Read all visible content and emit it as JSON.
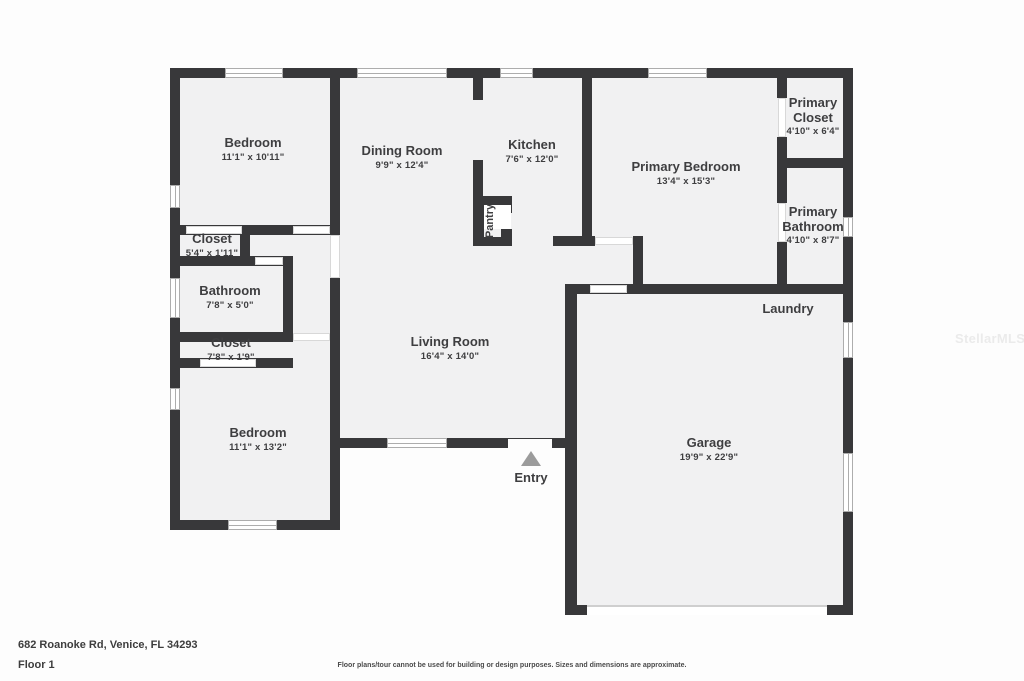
{
  "floorplan": {
    "rooms": [
      {
        "name": "Bedroom",
        "dims": "11'1\" x 10'11\""
      },
      {
        "name": "Dining Room",
        "dims": "9'9\" x 12'4\""
      },
      {
        "name": "Kitchen",
        "dims": "7'6\" x 12'0\""
      },
      {
        "name": "Primary Bedroom",
        "dims": "13'4\" x 15'3\""
      },
      {
        "name": "Primary Closet",
        "dims": "4'10\" x 6'4\""
      },
      {
        "name": "Primary Bathroom",
        "dims": "4'10\" x 8'7\""
      },
      {
        "name": "Closet",
        "dims": "5'4\" x 1'11\""
      },
      {
        "name": "Bathroom",
        "dims": "7'8\" x 5'0\""
      },
      {
        "name": "Closet",
        "dims": "7'8\" x 1'9\""
      },
      {
        "name": "Bedroom",
        "dims": "11'1\" x 13'2\""
      },
      {
        "name": "Living Room",
        "dims": "16'4\" x 14'0\""
      },
      {
        "name": "Garage",
        "dims": "19'9\" x 22'9\""
      }
    ],
    "pantry_label": "Pantry",
    "laundry_label": "Laundry",
    "entry_label": "Entry"
  },
  "watermark": "StellarMLS",
  "footer": {
    "address": "682 Roanoke Rd, Venice, FL 34293",
    "floor": "Floor 1",
    "disclaimer": "Floor plans/tour cannot be used for building or design purposes. Sizes and dimensions are approximate."
  },
  "colors": {
    "wall": "#38383a",
    "room_fill": "#f1f1f2",
    "text": "#3e3e40",
    "entry_arrow": "#9b9b9b"
  }
}
